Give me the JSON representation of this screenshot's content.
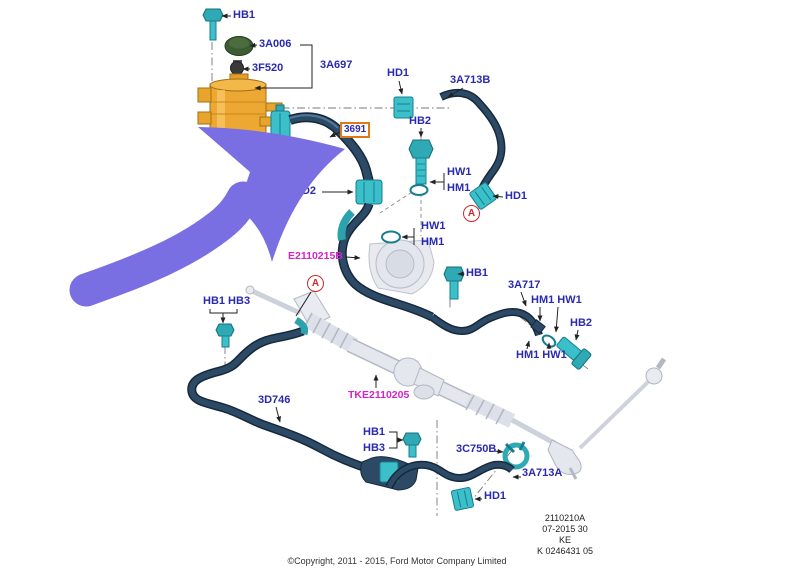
{
  "labels": {
    "hb1_top": "HB1",
    "a006": "3A006",
    "f520": "3F520",
    "a697": "3A697",
    "hd1_top": "HD1",
    "a713b": "3A713B",
    "hb2_mid": "HB2",
    "hw1_1": "HW1",
    "hm1_1": "HM1",
    "hd2": "HD2",
    "hd1_mid": "HD1",
    "hw1_2": "HW1",
    "hm1_2": "HM1",
    "e2110215b": "E2110215B",
    "hb1_mid": "HB1",
    "a717": "3A717",
    "hm1_hw1_top": "HM1 HW1",
    "hb2_right": "HB2",
    "hm1_hw1_bot": "HM1 HW1",
    "hb1_hb3": "HB1 HB3",
    "d746": "3D746",
    "tke2110205": "TKE2110205",
    "hb1_bot": "HB1",
    "hb3_bot": "HB3",
    "c750b": "3C750B",
    "a713a": "3A713A",
    "hd1_bot": "HD1"
  },
  "highlight_box": {
    "part_number": "3691"
  },
  "callouts": {
    "a": "A"
  },
  "stamp": {
    "line1": "2110210A",
    "line2": "07-2015 30",
    "line3": "KE",
    "line4": "K 0246431 05"
  },
  "copyright": "©Copyright, 2011 - 2015, Ford Motor Company Limited",
  "colors": {
    "label_blue": "#2a2ab0",
    "magenta": "#d423c8",
    "callout_red": "#cc2a2a",
    "highlight_orange": "#e07818",
    "hose_navy": "#24415e",
    "fitting_teal": "#3bbfc9",
    "reservoir_orange": "#eda833",
    "cap_green": "#3e5c33",
    "ghost_gray": "#c2c8d2",
    "annotation_purple": "#7a6ee3"
  }
}
